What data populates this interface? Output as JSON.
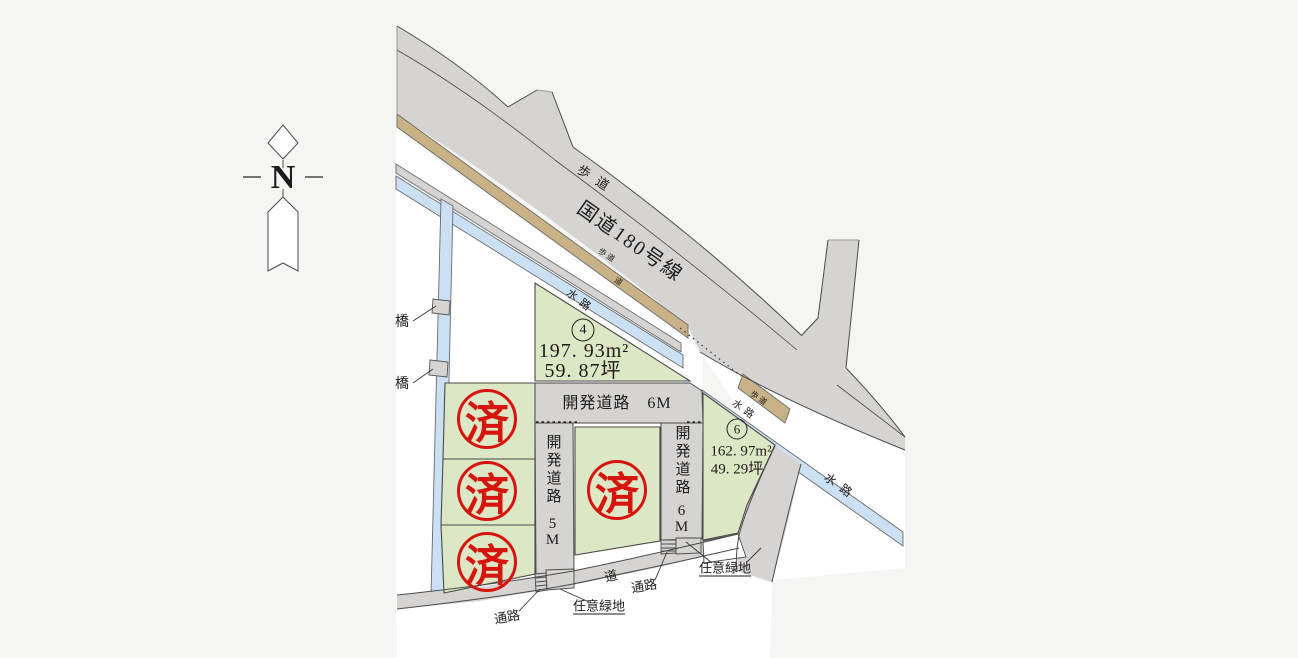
{
  "compass": {
    "north": "N"
  },
  "main_road": {
    "name": "国道180号線",
    "sidewalk": "歩道"
  },
  "waterway": {
    "channel": "水路",
    "bridge": "橋",
    "small_road": "道"
  },
  "site_roads": {
    "dev_6m_full": "開発道路　6M",
    "dev_name": "開発道路",
    "width_5m": "5M",
    "width_6m": "6M",
    "road": "道"
  },
  "lots": {
    "no4": {
      "num": "4",
      "area": "197. 93m²",
      "tsubo": "59. 87坪"
    },
    "no6": {
      "num": "6",
      "area": "162. 97m²",
      "tsubo": "49. 29坪"
    },
    "sold": "済"
  },
  "notes": {
    "passage": "通路",
    "green": "任意緑地"
  },
  "colors": {
    "road_gray": "#d6d4d2",
    "sidewalk_tan": "#c9b285",
    "water_blue": "#cbe1f3",
    "lot_green": "#dce8c5",
    "stamp_red": "#d7150f",
    "page_bg": "#f5f5f4"
  }
}
